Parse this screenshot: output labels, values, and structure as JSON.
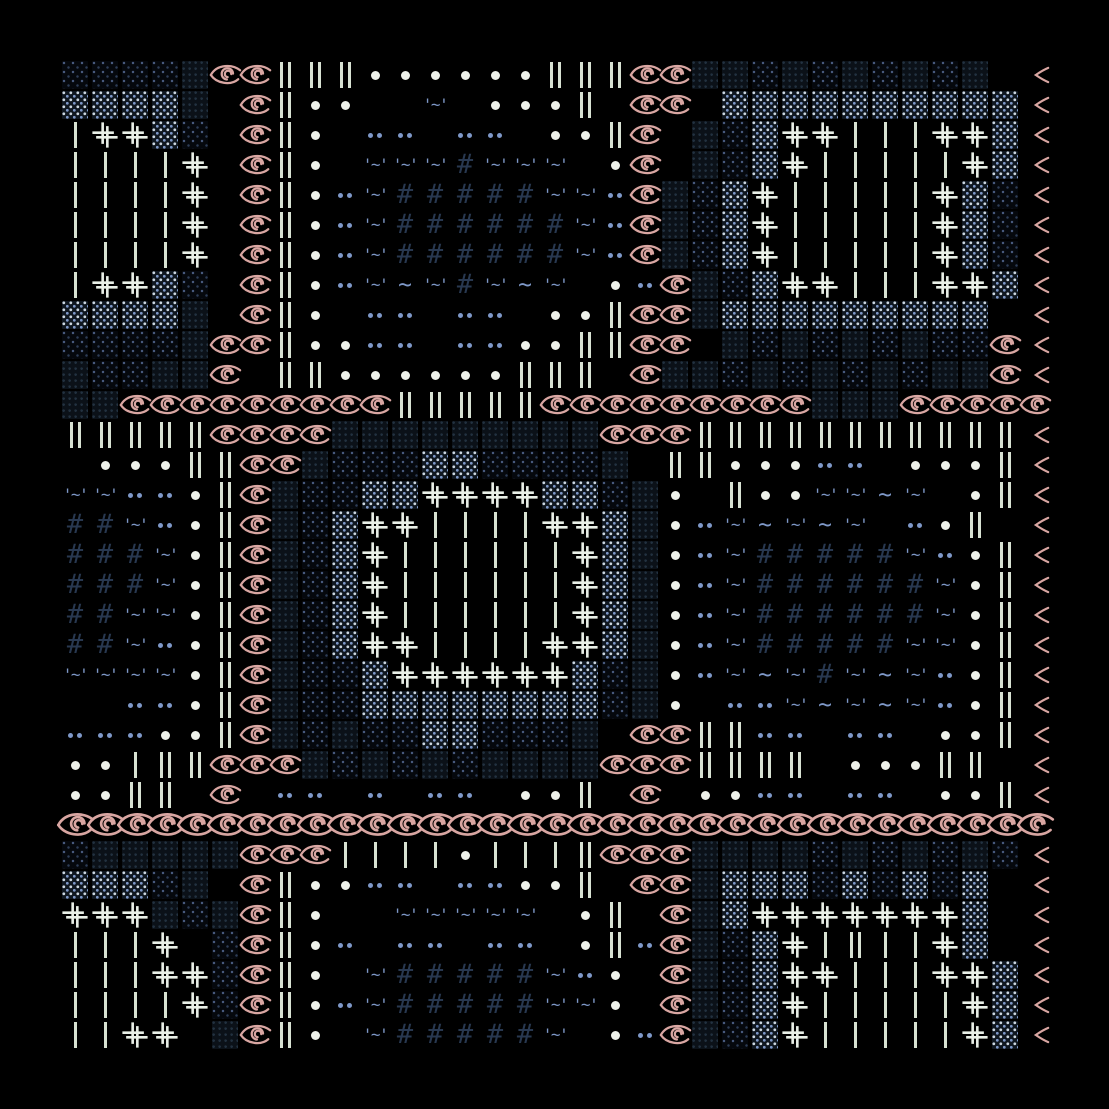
{
  "artwork": {
    "background": "#000000",
    "canvas_px": {
      "width": 1109,
      "height": 1109
    },
    "palette": {
      "bg": "#000000",
      "eye": "#d9a6a2",
      "bar": "#d8e2d3",
      "dot": "#eef1ea",
      "blue": "#7e98c8",
      "hash": "#283850",
      "plus": "#e9efe7",
      "dith_w": "#ccd7e1",
      "dith_bg": "#0f1720",
      "dith_dim": "#47597c",
      "dith_dim2": "#2e3d57",
      "dith_bg2": "#05080d",
      "dith_dark_dot": "#223140",
      "dith_dark_bg": "#0b1118"
    },
    "legend": {
      " ": {
        "name": "empty-cell",
        "kind": "empty"
      },
      "e": {
        "name": "eye-icon",
        "kind": "eye"
      },
      "E": {
        "name": "eye-large-icon",
        "kind": "eye-large"
      },
      "<": {
        "name": "eye-tip-icon",
        "kind": "eye-tip"
      },
      "I": {
        "name": "double-bar-glyph",
        "kind": "double-bar"
      },
      "l": {
        "name": "bar-glyph",
        "kind": "bar"
      },
      "o": {
        "name": "white-dot",
        "kind": "dot"
      },
      "b": {
        "name": "blue-dot-pair",
        "kind": "dot-pair"
      },
      "#": {
        "name": "hash-glyph",
        "kind": "text",
        "text": "#",
        "style": "t-hash"
      },
      "~": {
        "name": "tilde-glyph",
        "kind": "text",
        "text": "~",
        "style": "t-tilde"
      },
      "T": {
        "name": "quote-tilde-glyph",
        "kind": "text",
        "text": "'~'",
        "style": "t-quote"
      },
      "+": {
        "name": "double-plus-glyph",
        "kind": "plus"
      },
      "d": {
        "name": "dither-bright-block",
        "kind": "dither-bright"
      },
      "s": {
        "name": "dither-sparse-block",
        "kind": "dither-sparse"
      },
      "D": {
        "name": "dither-dark-block",
        "kind": "dither-dark"
      }
    },
    "grid": {
      "cols": 33,
      "rows": 33,
      "cell_px": 30,
      "origin_px": [
        60,
        60
      ],
      "rows_data": [
        "ssssDeeIIIooooooIIIeeDDsDsDsDsD <",
        "ddddD eIoo  T oooI ee dddddddddd<",
        "l++ds eIo bb bb ooIe Dsd++lll++d<",
        "llll+ eIo TTT#TTT oe Dsd+lllll+d<",
        "llll+ eIobT#####TTbeDsd+lllll+ds<",
        "llll+ eIobT######TbeDsd+lllll+ds<",
        "llll+ eIobT######TbeDsd+lllll+ds<",
        "l++ds eIobT~T#T~T obeDsd++lll++d<",
        "ddddD eIo bb bb ooIeeDddddddddd <",
        "ssssDeeIoobb bbooIIee DsDsDsDsse<",
        "DssDDe IIooooooIII eDDsDsDsDsDDe<",
        "DDeeeeeeeeeIIIIIeeeeeeeeeDDDeeeee",
        "IIIIIeeeeDDDDDDDDDeeeIIIIIIIIIII<",
        " oooIIeeDsssddssssD IIooobb oooI<",
        "TTbboIeDssdd++++ddsDo IooTT~T oI<",
        "##TboIeDsd++llll++dDobT~T~T boI <",
        "###ToIeDsd+llllll+dDobT#####TboI<",
        "###ToIeDsd+llllll+dDobT######ToI<",
        "##TToIeDsd+llllll+dDobT######ToI<",
        "##TboIeDsd++llll++dDobT#####TToI<",
        "TTTToIeDssd++++++dsDobT~T#T~TboI<",
        "  bboIeDssddddddddsDo bbT~T~TboI<",
        "bbbooIeDsDssddsssD eeIIbb bb ooI<",
        "oolIIeeeDsDsDsDDDDeeeIIII oooII <",
        "ooII e bb b bb ooI e oobb bb ooI<",
        "EEEEEEEEEEEEEEEEEEEEEEEEEEEEEEEEE",
        "sDDDDDeeellllolllIeeeDDDDsDsDsDs<",
        "dddsD eIoobb bbooI eeDdddsdsdsd <",
        "+++DsDeIo  TTTTT oI eDd+++++++d <",
        "lll+ seIob bb bb oIbeDsd+lIll+d <",
        "lll++seIo T#####Tbo eDsd++lll++d<",
        "llll+seIobT#####TTo eDsd+lllll+d<",
        "ll++ DeIo T#####T obeDsd+lllll+d<"
      ]
    }
  }
}
